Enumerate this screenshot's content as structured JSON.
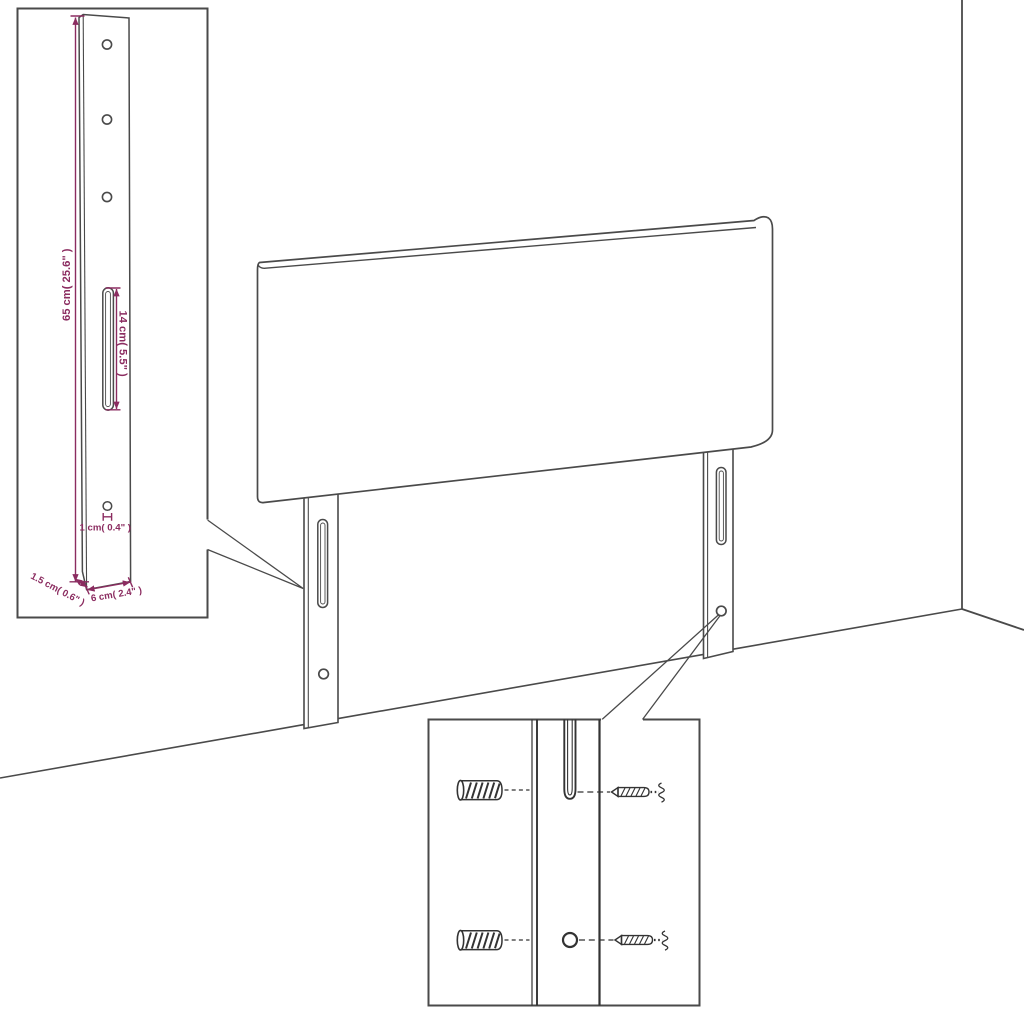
{
  "diagram": {
    "title": "Headboard with wall-mount legs — dimension and mounting detail drawing",
    "colors": {
      "background": "#ffffff",
      "outline": "#4a4a4a",
      "dimension": "#8b2c60"
    },
    "leg_detail_inset": {
      "name": "leg dimension detail",
      "labels": {
        "height": "65 cm( 25.6\" )",
        "slot_length": "14 cm( 5.5\" )",
        "hole_diameter": "1 cm( 0.4\" )",
        "thickness": "1.5 cm( 0.6\" )",
        "width": "6 cm( 2.4\" )"
      },
      "features": [
        "mounting-hole",
        "mounting-hole",
        "mounting-hole",
        "keyhole-slot",
        "small-hole"
      ]
    },
    "main_view": {
      "parts": [
        "headboard-panel",
        "left-leg",
        "right-leg",
        "wall-corner",
        "floor-line"
      ]
    },
    "hardware_inset": {
      "name": "wall mounting hardware detail",
      "rows": [
        {
          "left": "wall-plug-icon",
          "center": "keyhole-slot",
          "right": "screw-icon"
        },
        {
          "left": "wall-plug-icon",
          "center": "round-hole",
          "right": "screw-icon"
        }
      ]
    }
  }
}
